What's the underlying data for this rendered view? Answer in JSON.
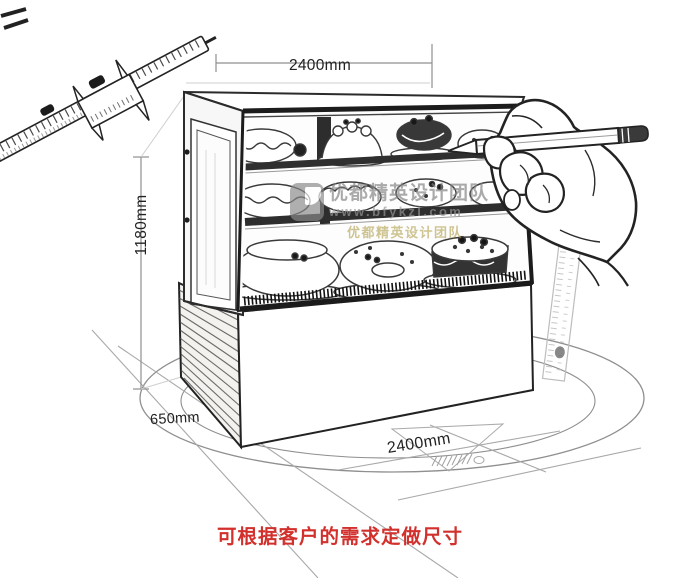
{
  "dimension_labels": {
    "width_top": "2400mm",
    "height_left": "1180mm",
    "depth_bottom_left": "650mm",
    "width_bottom": "2400mm"
  },
  "caption": {
    "text": "可根据客户的需求定做尺寸",
    "color": "#d2302c"
  },
  "watermark": {
    "team_name": "优都精英设计团队",
    "website": "www.bfykzl.com",
    "color": "#8a8a8a"
  },
  "illustration": {
    "elements": [
      "vernier-caliper-sketch",
      "cake-display-cabinet-sketch",
      "cake-sketches",
      "wood-base-sketch",
      "hand-holding-pencil-sketch",
      "steel-ruler-sketch",
      "set-square-sketch",
      "floor-guide-ellipses"
    ],
    "ink_color": "#232323",
    "guide_color": "#9a9a9a"
  }
}
